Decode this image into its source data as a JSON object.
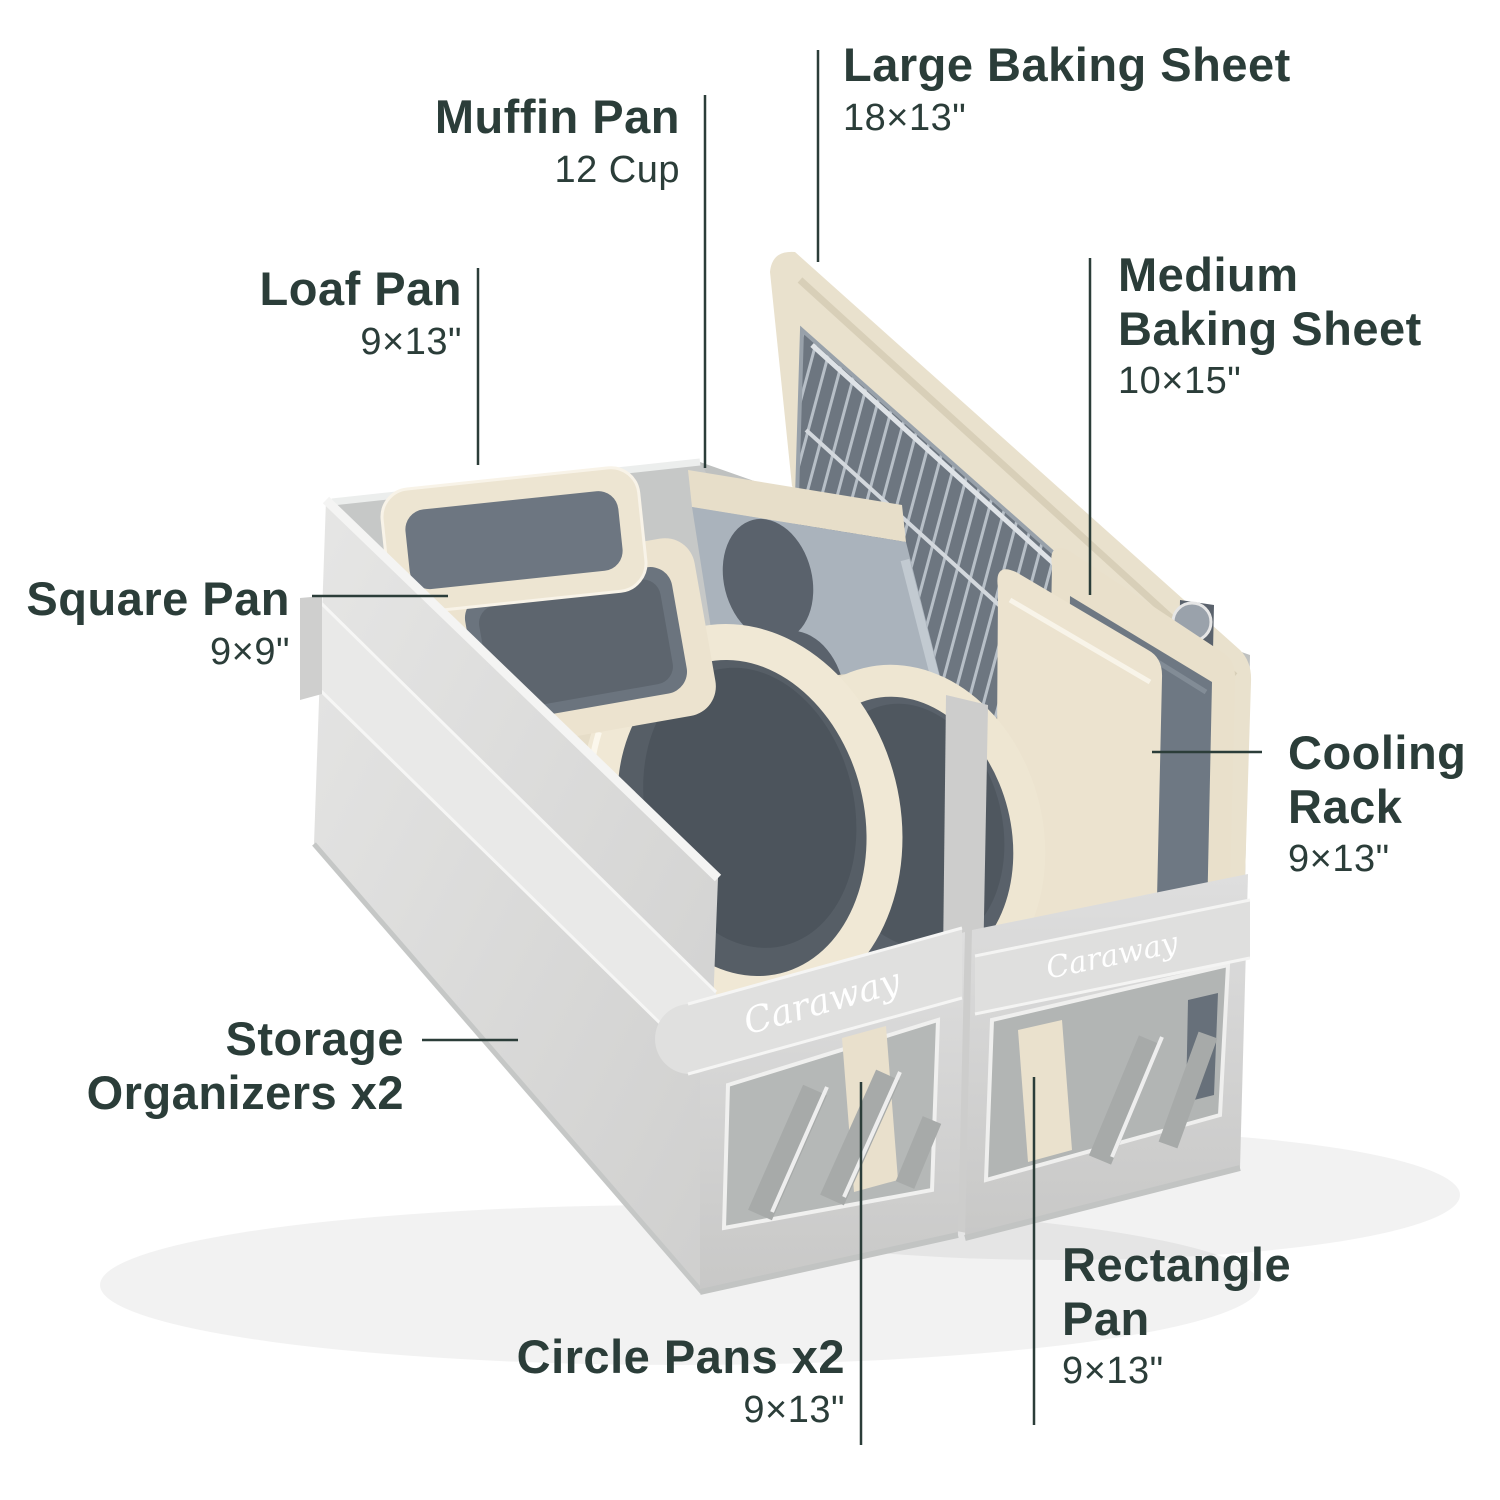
{
  "brand": {
    "logo_text": "Caraway"
  },
  "colors": {
    "label_text": "#2b3d39",
    "leader_line": "#2b3d39",
    "fabric_light": "#e7e7e6",
    "fabric": "#d9d9d8",
    "fabric_dark": "#b5b8b7",
    "cream": "#ece3cf",
    "slate": "#6e7882",
    "slate_dark": "#565e67",
    "background": "#ffffff"
  },
  "callouts": {
    "muffin_pan": {
      "name": "Muffin Pan",
      "size": "12 Cup"
    },
    "large_baking_sheet": {
      "name": "Large Baking Sheet",
      "size": "18×13\""
    },
    "medium_baking_sheet": {
      "name": "Medium Baking Sheet",
      "size": "10×15\""
    },
    "loaf_pan": {
      "name": "Loaf Pan",
      "size": "9×13\""
    },
    "square_pan": {
      "name": "Square Pan",
      "size": "9×9\""
    },
    "cooling_rack": {
      "name": "Cooling Rack",
      "size": "9×13\""
    },
    "storage_organizers": {
      "name": "Storage Organizers x2",
      "size": ""
    },
    "circle_pans": {
      "name": "Circle Pans x2",
      "size": "9×13\""
    },
    "rectangle_pan": {
      "name": "Rectangle Pan",
      "size": "9×13\""
    }
  }
}
